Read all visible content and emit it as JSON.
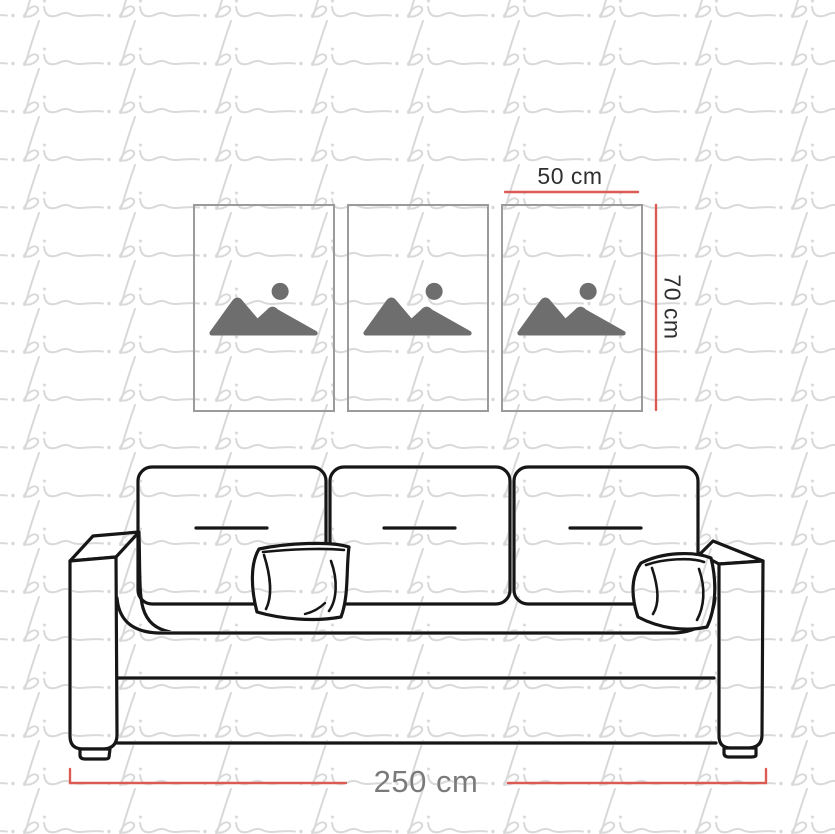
{
  "watermark": {
    "text": "pi",
    "color": "#d9d9d9",
    "repeat": "tiled"
  },
  "frames": {
    "count": 3,
    "icon": "image-placeholder-icon",
    "icon_color": "#6e6e6e",
    "border_color": "#9b9b9b",
    "background": "#ffffff"
  },
  "sofa": {
    "back_cushions": 3,
    "throw_pillows": 2,
    "armrests": 2,
    "line_color": "#161616"
  },
  "dimensions": {
    "frame_width_label": "50 cm",
    "frame_height_label": "70 cm",
    "sofa_width_label": "250 cm",
    "line_color": "#dc5b53",
    "frame_label_color": "#2f2f2f",
    "sofa_label_color": "#7a7a7a"
  }
}
